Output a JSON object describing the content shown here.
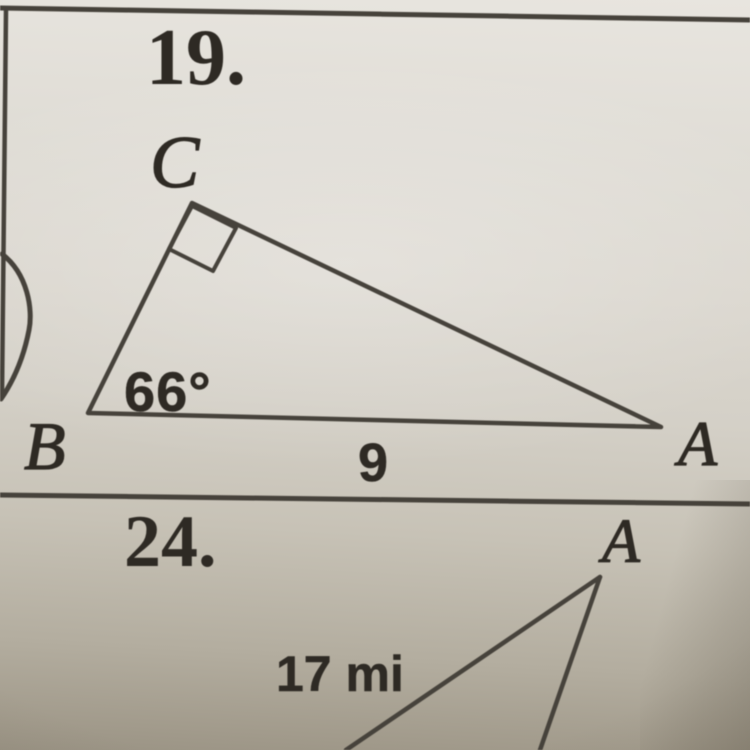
{
  "page": {
    "paper_color": "#d9d5cd",
    "ink_color": "#46423b",
    "text_color": "#2e2a24"
  },
  "problem19": {
    "number": "19.",
    "vertex_top": "C",
    "vertex_left": "B",
    "vertex_right": "A",
    "angle_at_b": "66°",
    "side_ab": "9"
  },
  "problem24": {
    "number": "24.",
    "vertex_top": "A",
    "side_hypotenuse": "17 mi"
  }
}
